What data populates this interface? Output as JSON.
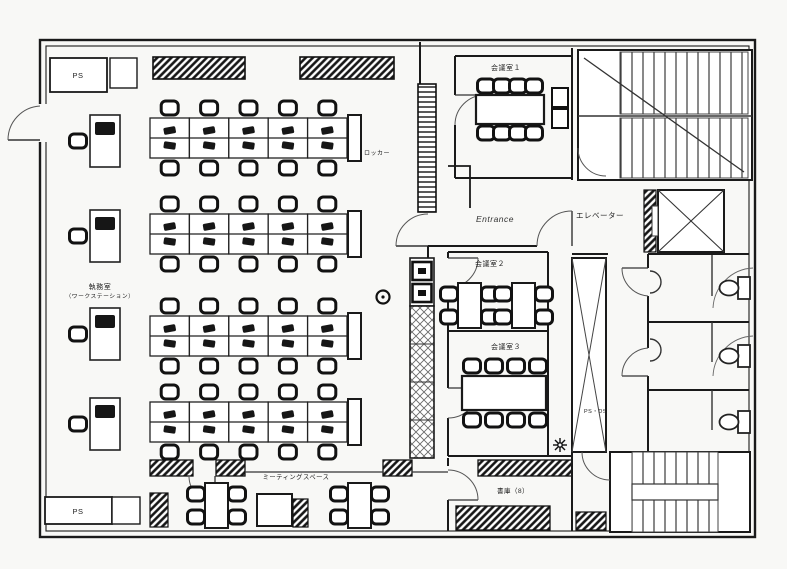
{
  "page": {
    "background": "#f8f8f6",
    "ink": "#1a1a1a"
  },
  "labels": {
    "ps_top": "PS",
    "ps_bottom": "PS",
    "office_line1": "執務室",
    "office_line2": "（ワークステーション）",
    "locker": "ロッカー",
    "entrance": "Entrance",
    "meeting_room_1": "会議室１",
    "meeting_room_2": "会議室２",
    "meeting_room_3": "会議室３",
    "meeting_space": "ミーティングスペース",
    "storage_room": "書庫（8）",
    "elevator": "エレベーター",
    "shaft": "PS・DS"
  },
  "plan": {
    "type": "office-floor-plan",
    "workstation_islands": 4,
    "desk_columns_per_island": 5,
    "desks_per_island": 10,
    "total_island_desks": 40,
    "wall_desks": 4,
    "meeting_room_chairs": {
      "meeting_room_1": 8,
      "meeting_room_2": 8,
      "meeting_room_3": 8
    },
    "meeting_space_tables": 2,
    "stairwells": 2,
    "elevators": 1,
    "toilet_stalls": 3
  }
}
